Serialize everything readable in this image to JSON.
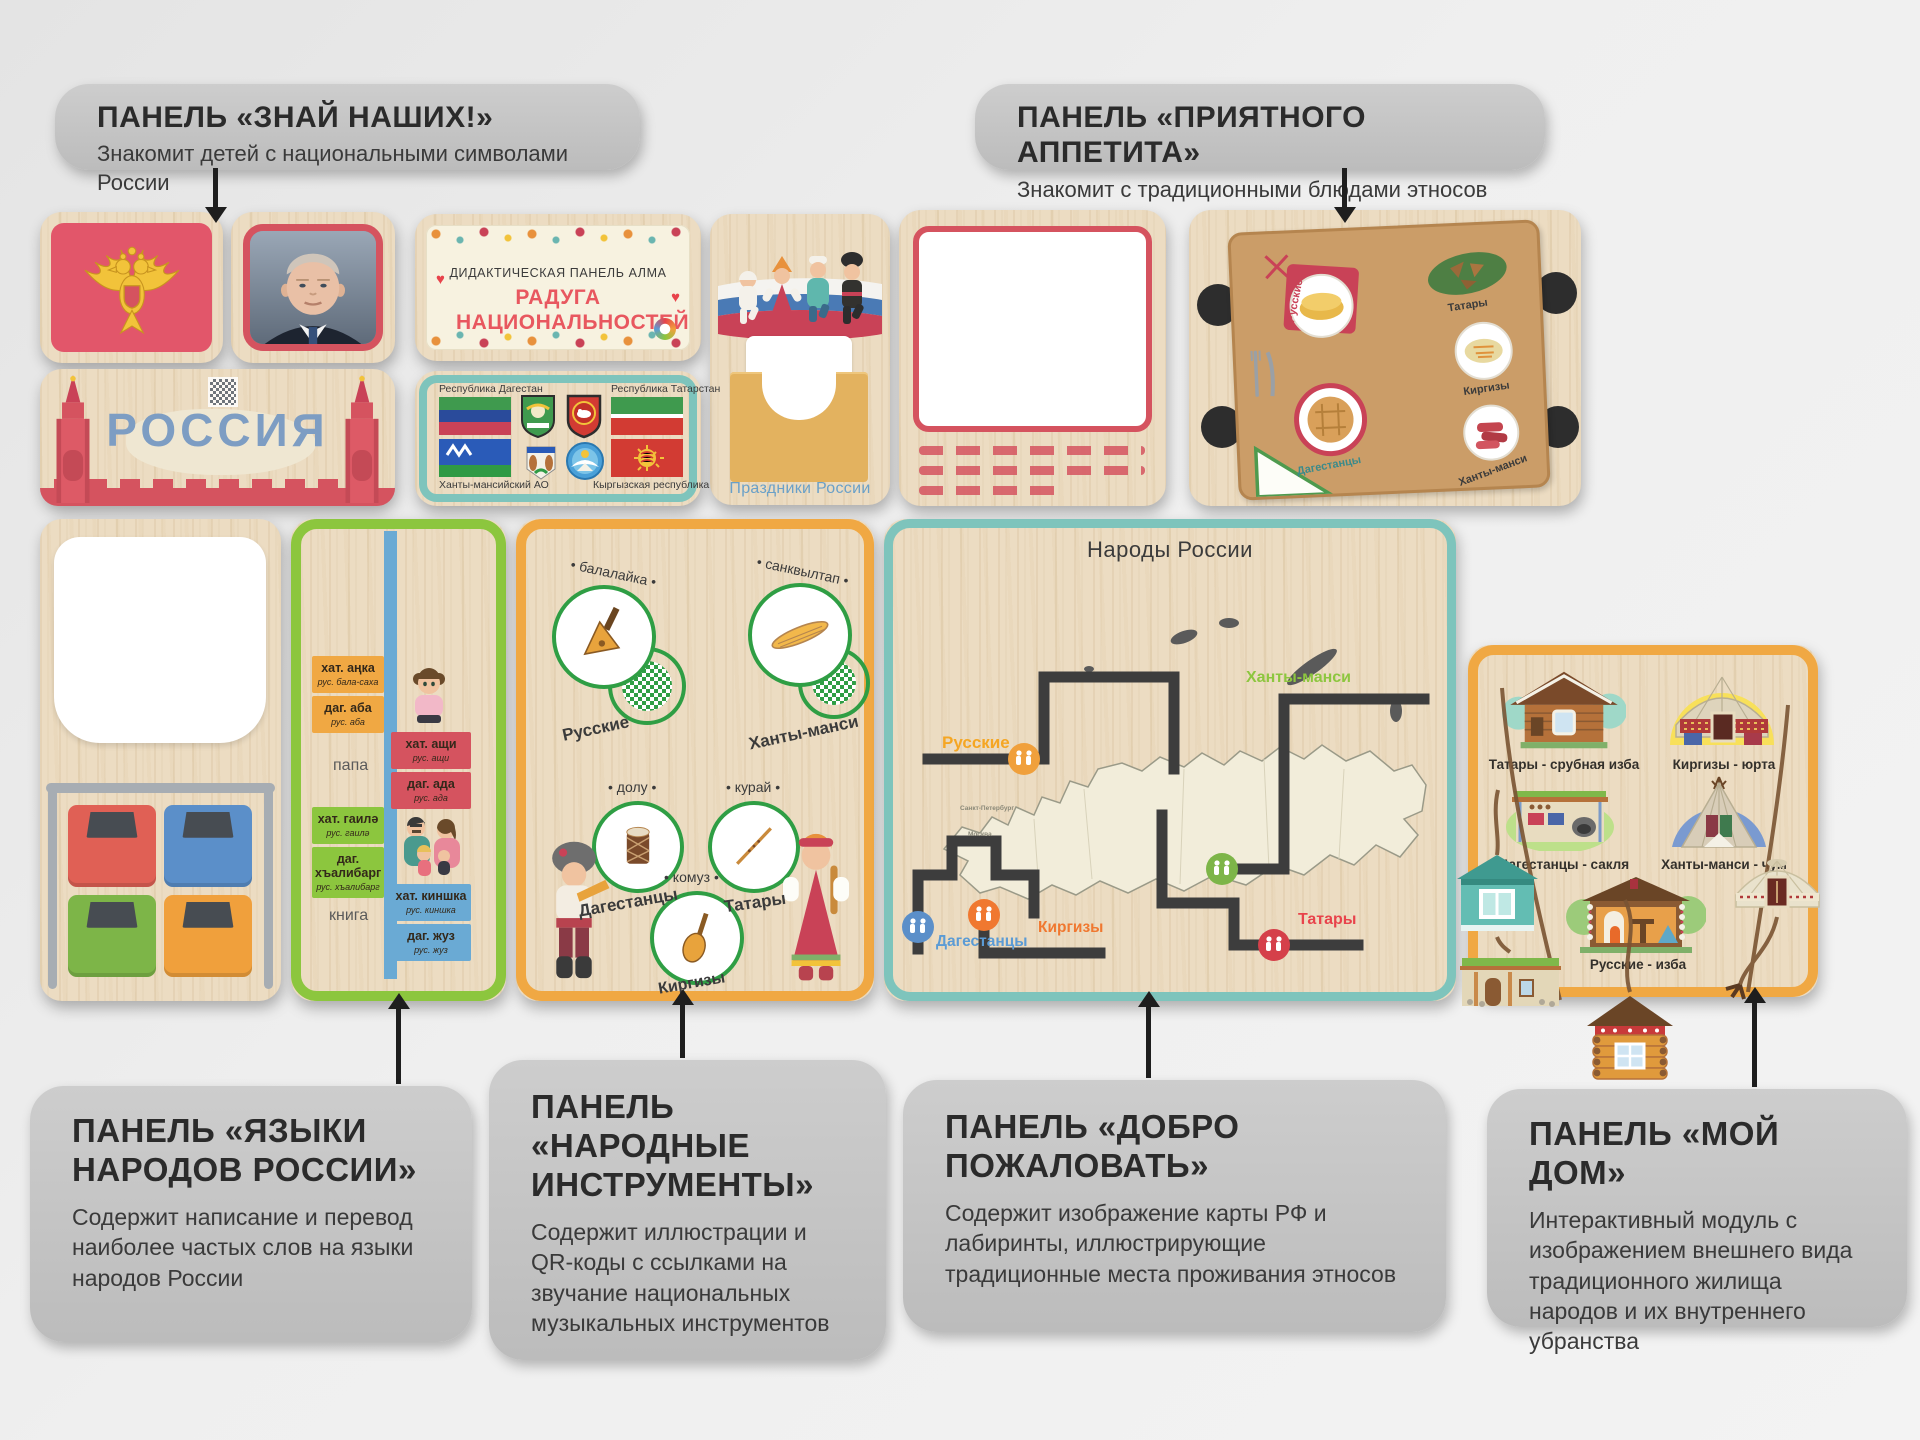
{
  "colors": {
    "background": "#ededed",
    "callout_bg": "#c3c3c3",
    "wood": "#ecdcc2",
    "red_accent": "#d5535f",
    "teal_border": "#7ec4bc",
    "orange_border": "#f0a843",
    "green_border": "#8cc63e",
    "blue_bar": "#6aaad4",
    "title_red": "#e8575f",
    "russia_blue": "#7d9dc3",
    "holidays_blue": "#6aa0c8"
  },
  "callouts": {
    "znai": {
      "title": "ПАНЕЛЬ «ЗНАЙ НАШИХ!»",
      "desc": "Знакомит детей с национальными символами России"
    },
    "appetit": {
      "title": "ПАНЕЛЬ «ПРИЯТНОГО АППЕТИТА»",
      "desc": "Знакомит с традиционными блюдами этносов"
    },
    "languages": {
      "title": "ПАНЕЛЬ «ЯЗЫКИ НАРОДОВ РОССИИ»",
      "desc": "Содержит написание и перевод наиболее частых слов на языки народов России"
    },
    "instruments": {
      "title": "ПАНЕЛЬ «НАРОДНЫЕ ИНСТРУМЕНТЫ»",
      "desc": "Содержит иллюстрации и QR-коды с ссылками на звучание национальных музыкальных инструментов"
    },
    "welcome": {
      "title": "ПАНЕЛЬ «ДОБРО ПОЖАЛОВАТЬ»",
      "desc": "Содержит изображение карты РФ и лабиринты, иллюстрирующие традиционные места проживания этносов"
    },
    "home": {
      "title": "ПАНЕЛЬ «МОЙ ДОМ»",
      "desc": "Интерактивный модуль с изображением внешнего вида традиционного жилища народов и их внутреннего убранства"
    }
  },
  "title_panel": {
    "kicker": "ДИДАКТИЧЕСКАЯ ПАНЕЛЬ АЛМА",
    "title": "РАДУГА НАЦИОНАЛЬНОСТЕЙ"
  },
  "russia_panel": {
    "label": "РОССИЯ"
  },
  "holidays_panel": {
    "label": "Праздники России"
  },
  "flags_panel": {
    "dagestan": "Республика Дагестан",
    "tatarstan": "Республика Татарстан",
    "khanty": "Ханты-мансийский АО",
    "kyrgyz": "Кыргызская республика"
  },
  "food_panel": {
    "labels": [
      "Русские",
      "Татары",
      "Киргизы",
      "Дагестанцы",
      "Ханты-манси"
    ]
  },
  "language_panel": {
    "words": [
      "папа",
      "книга"
    ],
    "cards": [
      {
        "top_main": "хат. аңка",
        "top_sub": "рус. бала-саха",
        "bot_main": "даг. аба",
        "bot_sub": "рус. аба"
      },
      {
        "top_main": "хат. ащи",
        "top_sub": "рус. ащи",
        "bot_main": "даг. ада",
        "bot_sub": "рус. ада"
      },
      {
        "top_main": "хат. гаилә",
        "top_sub": "рус. гаилә",
        "bot_main": "даг. хъалибарг",
        "bot_sub": "рус. хъалибарг"
      },
      {
        "top_main": "хат. киншка",
        "top_sub": "рус. киншка",
        "bot_main": "даг. жуз",
        "bot_sub": "рус. жуз"
      }
    ]
  },
  "instruments_panel": {
    "items": [
      {
        "name": "балалайка",
        "ethnos": "Русские"
      },
      {
        "name": "санквылтап",
        "ethnos": "Ханты-манси"
      },
      {
        "name": "долу",
        "ethnos": "Дагестанцы"
      },
      {
        "name": "курай",
        "ethnos": "Татары"
      },
      {
        "name": "комуз",
        "ethnos": "Киргизы"
      }
    ]
  },
  "map_panel": {
    "title": "Народы России",
    "cities": [
      "Санкт-Петербург",
      "Москва"
    ],
    "labels": [
      {
        "text": "Русские",
        "color": "#f5a623"
      },
      {
        "text": "Ханты-манси",
        "color": "#8dc63f"
      },
      {
        "text": "Дагестанцы",
        "color": "#5b9bd5"
      },
      {
        "text": "Киргизы",
        "color": "#f07830"
      },
      {
        "text": "Татары",
        "color": "#e8434b"
      }
    ]
  },
  "houses_panel": {
    "items": [
      {
        "label": "Татары - срубная изба"
      },
      {
        "label": "Киргизы - юрта"
      },
      {
        "label": "Дагестанцы - сакля"
      },
      {
        "label": "Ханты-манси - чум"
      },
      {
        "label": "Русские - изба"
      }
    ]
  }
}
